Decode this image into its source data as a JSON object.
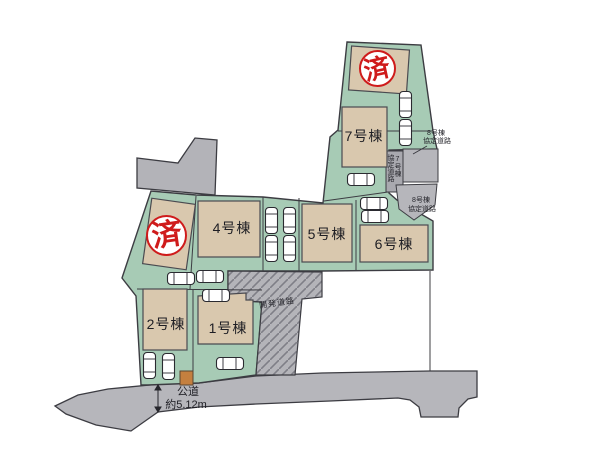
{
  "title": "分譲地 区画図",
  "buildings": [
    {
      "id": "1",
      "label": "1号棟"
    },
    {
      "id": "2",
      "label": "2号棟"
    },
    {
      "id": "4",
      "label": "4号棟"
    },
    {
      "id": "5",
      "label": "5号棟"
    },
    {
      "id": "6",
      "label": "6号棟"
    },
    {
      "id": "7",
      "label": "7号棟"
    }
  ],
  "stamps": {
    "sold_top": "済",
    "sold_left": "済"
  },
  "annotations": {
    "dev_road": "開発道路",
    "agreement_upper_l1": "8号棟",
    "agreement_upper_l2": "協定道路",
    "agreement_lower_l1": "8号棟",
    "agreement_lower_l2": "協定道路",
    "agreement_vertical_col_right": "7号棟",
    "agreement_vertical_col_left": "協定道路",
    "public_road_l1": "公道",
    "public_road_l2": "約5.12m"
  },
  "colors": {
    "lot_green": "#a7cbb5",
    "building_beige": "#d9c8ae",
    "road_gray": "#b6b6bb",
    "hatch_line_gray": "#7f7f87",
    "outline_dark": "#3c3c42",
    "stamp_red": "#cf1b1b",
    "shed_brown": "#c5803f",
    "car_white": "#ffffff"
  }
}
